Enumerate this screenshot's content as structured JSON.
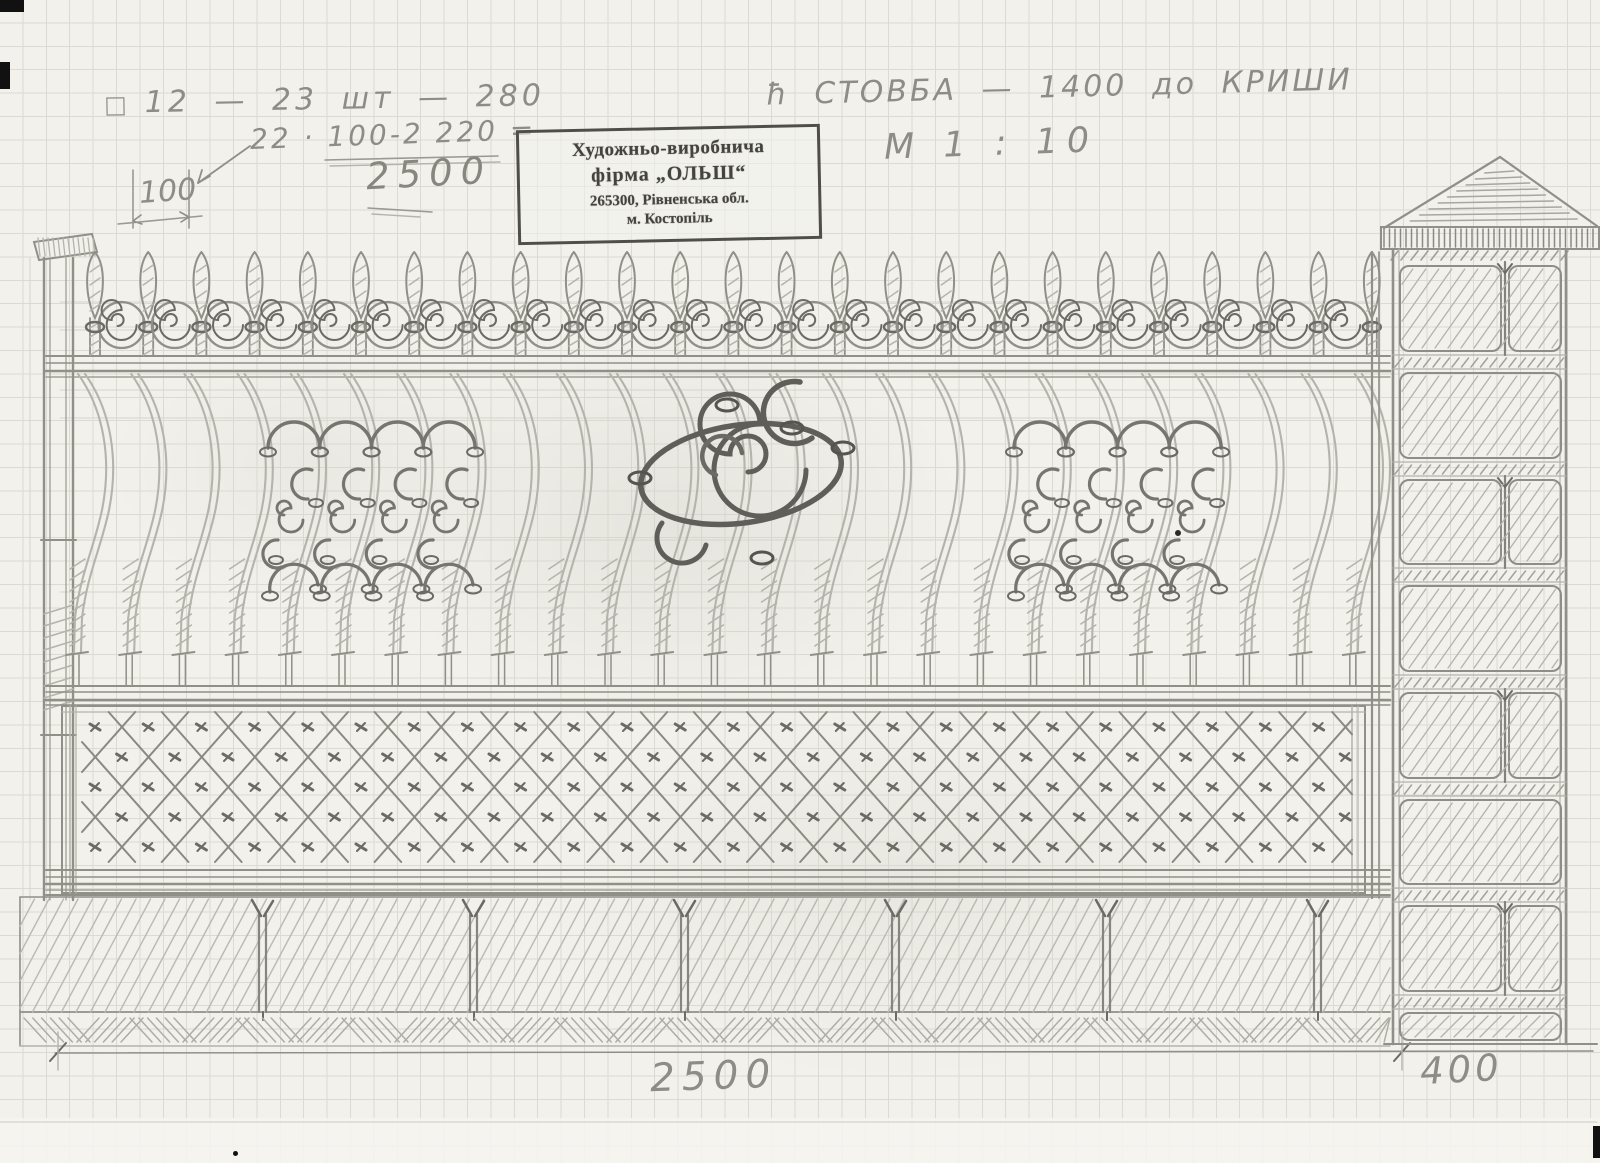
{
  "page": {
    "title": "Кований паркан — ескіз олівцем"
  },
  "annotations": {
    "spec_square": "□",
    "spec_line": "12 — 23 шт — 280",
    "calc_line": "22 · 100-2 220 =",
    "calc_total": "2500",
    "detail_dim": "100",
    "post_note": "ħ СТОВБА — 1400 до КРИШИ",
    "scale_note": "М 1 : 10",
    "panel_width_dim": "2500",
    "pillar_width_dim": "400"
  },
  "stamp": {
    "line1": "Художньо-виробнича",
    "line2": "фірма „ОЛЬШ“",
    "line3": "265300, Рівненська обл.",
    "line4": "м. Костопіль"
  },
  "figure": {
    "type": "pencil sketch, forged fence panel with brick pillar",
    "pickets": 25,
    "scrolls": 24,
    "curved_bars": 25,
    "ornament_columns": 4,
    "base_posts": 6,
    "brick_courses": 8
  },
  "colors": {
    "paper": "#f2f1eb",
    "grid": "#dbdad3",
    "pencil_faint": "#d5d4cd",
    "pencil_light": "#b4b3ac",
    "pencil_mid": "#908f88",
    "pencil_dark": "#6b6a64",
    "pencil_ink": "#55544e",
    "stamp_ink": "#45433e"
  }
}
